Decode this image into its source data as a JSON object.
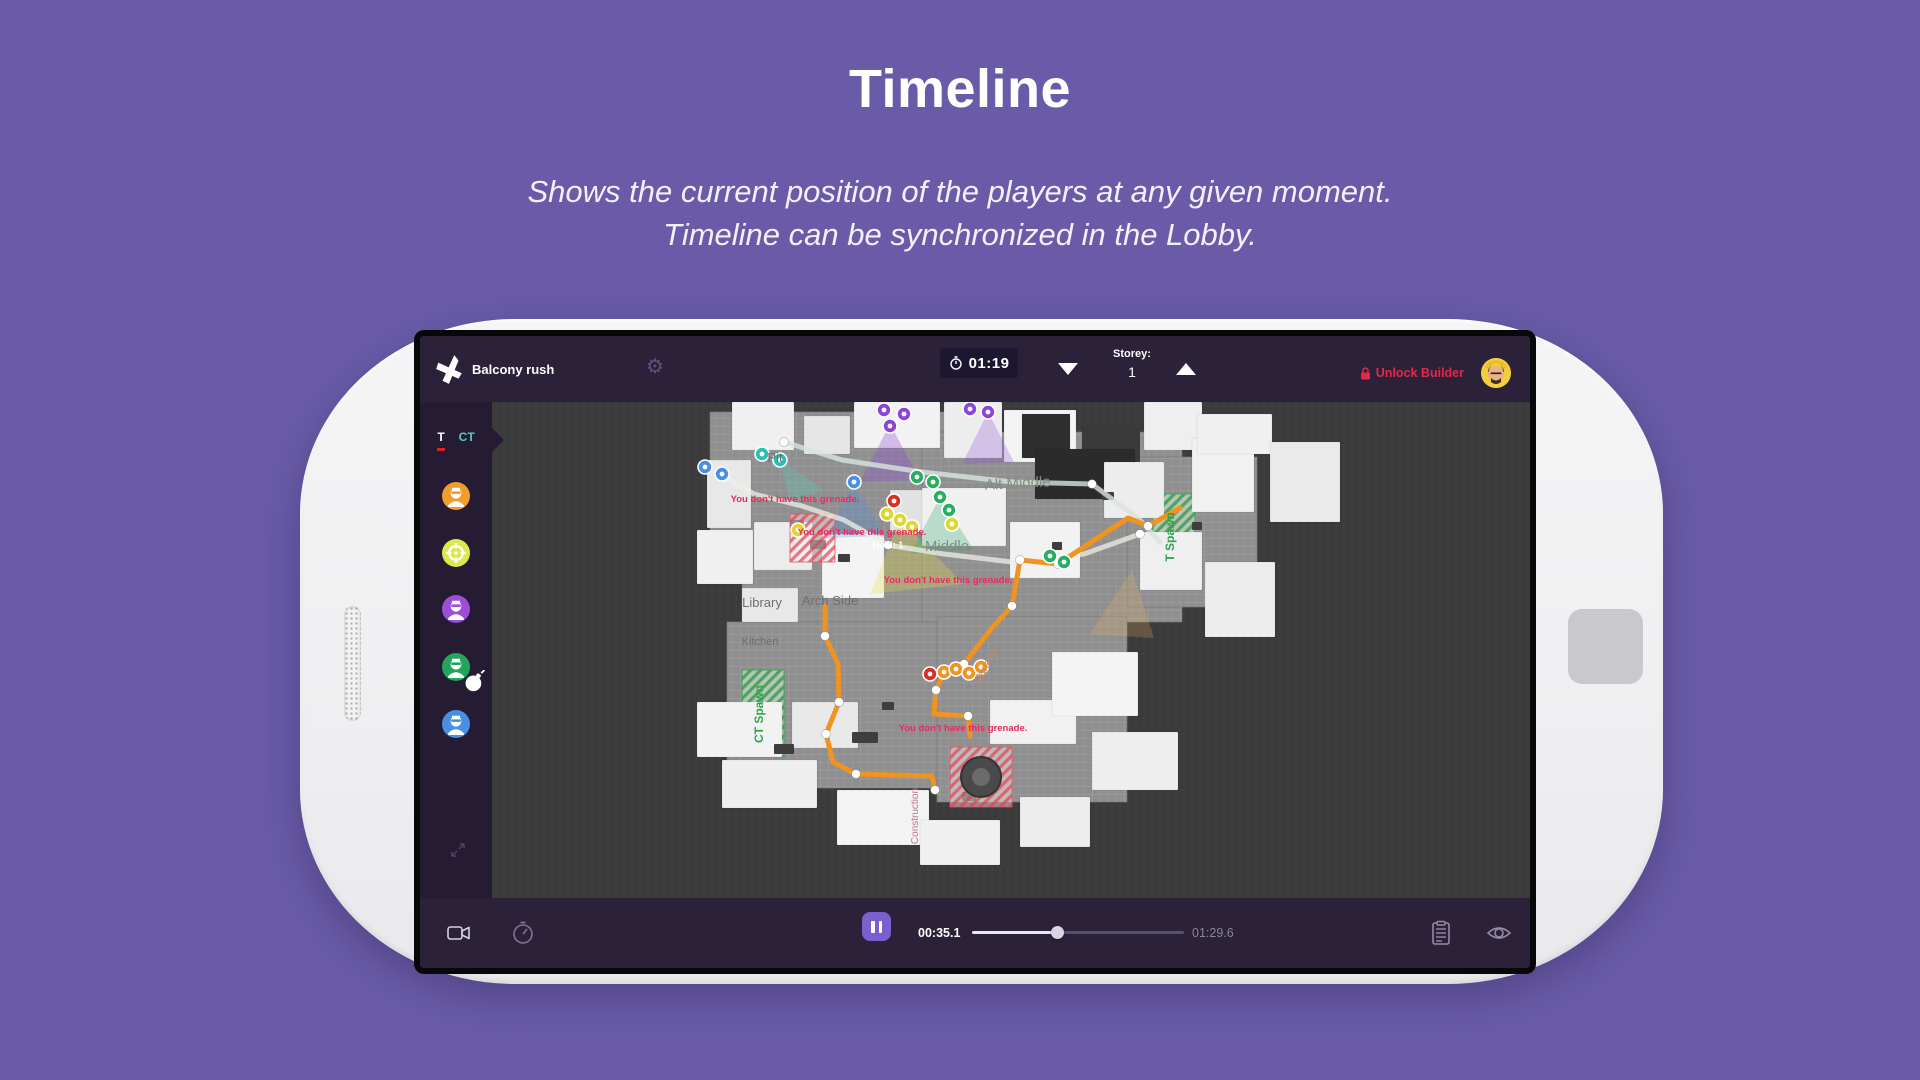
{
  "page": {
    "title": "Timeline",
    "subtitle_line1": "Shows the current position of the players at any given moment.",
    "subtitle_line2": "Timeline can be synchronized in the Lobby."
  },
  "app": {
    "topbar": {
      "strategy_name": "Balcony rush",
      "round_timer": "01:19",
      "storey_label": "Storey:",
      "storey_value": "1",
      "unlock_builder_label": "Unlock Builder"
    },
    "sidebar": {
      "tab_t": "T",
      "tab_ct": "CT",
      "players": [
        {
          "color": "#f09d2e",
          "icon": "terrorist"
        },
        {
          "color": "#dbe84e",
          "icon": "crosshair"
        },
        {
          "color": "#9b4fd6",
          "icon": "terrorist"
        },
        {
          "color": "#22a55c",
          "icon": "terrorist-bomb"
        },
        {
          "color": "#4a90e2",
          "icon": "terrorist"
        }
      ]
    },
    "timeline": {
      "current_time": "00:35.1",
      "total_time": "01:29.6",
      "progress_pct": 40
    },
    "map": {
      "warning_text": "You don't have this grenade.",
      "warnings": [
        [
          303,
          100
        ],
        [
          370,
          133
        ],
        [
          456,
          181
        ],
        [
          471,
          329
        ]
      ],
      "floors": [
        [
          218,
          10,
          240,
          120
        ],
        [
          250,
          120,
          210,
          100
        ],
        [
          235,
          220,
          215,
          166
        ],
        [
          430,
          30,
          260,
          190
        ],
        [
          445,
          215,
          190,
          185
        ],
        [
          635,
          55,
          130,
          150
        ]
      ],
      "buildings": [
        [
          240,
          0,
          62,
          48,
          "#f0f0f0"
        ],
        [
          312,
          14,
          46,
          38,
          "#e6e6e6"
        ],
        [
          362,
          0,
          86,
          46,
          "#f2f2f2"
        ],
        [
          452,
          0,
          58,
          56,
          "#ededed"
        ],
        [
          512,
          8,
          72,
          52,
          "#f4f4f4"
        ],
        [
          530,
          12,
          48,
          44,
          "#2e2e2e"
        ],
        [
          590,
          26,
          58,
          40,
          "#3a3a3a"
        ],
        [
          652,
          0,
          58,
          48,
          "#efefef"
        ],
        [
          700,
          36,
          62,
          74,
          "#f1f1f1"
        ],
        [
          705,
          12,
          75,
          40,
          "#f0f0f0"
        ],
        [
          778,
          40,
          70,
          80,
          "#eaeaea"
        ],
        [
          713,
          160,
          70,
          75,
          "#ededed"
        ],
        [
          215,
          58,
          44,
          68,
          "#e8e8e8"
        ],
        [
          205,
          128,
          56,
          54,
          "#f0f0f0"
        ],
        [
          262,
          120,
          58,
          48,
          "#ececec"
        ],
        [
          330,
          132,
          62,
          64,
          "#f4f4f4"
        ],
        [
          398,
          88,
          52,
          42,
          "#e2e2e2"
        ],
        [
          430,
          86,
          84,
          58,
          "#f0f0f0"
        ],
        [
          543,
          47,
          100,
          50,
          "#2b2b2b"
        ],
        [
          518,
          120,
          70,
          56,
          "#f2f2f2"
        ],
        [
          612,
          60,
          60,
          56,
          "#ededed"
        ],
        [
          648,
          130,
          62,
          58,
          "#efefef"
        ],
        [
          250,
          186,
          56,
          34,
          "#e8e8e8"
        ],
        [
          205,
          300,
          85,
          55,
          "#f2f2f2"
        ],
        [
          230,
          358,
          95,
          48,
          "#eeeeee"
        ],
        [
          300,
          300,
          66,
          46,
          "#e9e9e9"
        ],
        [
          345,
          388,
          92,
          55,
          "#f3f3f3"
        ],
        [
          498,
          298,
          86,
          44,
          "#f1f1f1"
        ],
        [
          560,
          250,
          86,
          64,
          "#f4f4f4"
        ],
        [
          600,
          330,
          86,
          58,
          "#eeeeee"
        ],
        [
          528,
          395,
          70,
          50,
          "#ededed"
        ],
        [
          428,
          418,
          80,
          45,
          "#f0f0f0"
        ]
      ],
      "props": [
        [
          298,
          118,
          14,
          9
        ],
        [
          318,
          138,
          16,
          9
        ],
        [
          346,
          152,
          12,
          8
        ],
        [
          282,
          342,
          20,
          10
        ],
        [
          390,
          300,
          12,
          8
        ],
        [
          560,
          140,
          10,
          8
        ],
        [
          610,
          90,
          12,
          8
        ],
        [
          700,
          120,
          10,
          8
        ],
        [
          470,
          390,
          14,
          9
        ],
        [
          360,
          330,
          26,
          11
        ]
      ],
      "zones_green": [
        [
          250,
          268,
          42,
          87
        ],
        [
          661,
          92,
          42,
          85
        ]
      ],
      "zones_red": [
        [
          298,
          112,
          45,
          48
        ],
        [
          458,
          345,
          62,
          60
        ]
      ],
      "fountain": {
        "cx": 489,
        "cy": 375,
        "r": 20
      },
      "cones": [
        {
          "p": [
            [
              398,
              22
            ],
            [
              368,
              80
            ],
            [
              428,
              78
            ]
          ],
          "f": "rgba(140,70,215,0.32)"
        },
        {
          "p": [
            [
              496,
              10
            ],
            [
              470,
              62
            ],
            [
              522,
              60
            ]
          ],
          "f": "rgba(140,70,215,0.26)"
        },
        {
          "p": [
            [
              408,
              118
            ],
            [
              378,
              192
            ],
            [
              472,
              182
            ]
          ],
          "f": "rgba(232,222,70,0.30)"
        },
        {
          "p": [
            [
              448,
              95
            ],
            [
              418,
              152
            ],
            [
              482,
              148
            ]
          ],
          "f": "rgba(40,170,100,0.28)"
        },
        {
          "p": [
            [
              362,
              80
            ],
            [
              334,
              136
            ],
            [
              394,
              134
            ]
          ],
          "f": "rgba(75,140,235,0.26)"
        },
        {
          "p": [
            [
              288,
              58
            ],
            [
              298,
              102
            ],
            [
              332,
              88
            ]
          ],
          "f": "rgba(80,210,190,0.26)"
        },
        {
          "p": [
            [
              640,
              168
            ],
            [
              598,
              232
            ],
            [
              662,
              236
            ]
          ],
          "f": "rgba(240,180,90,0.22)"
        }
      ],
      "paths": [
        {
          "c": "#d9e4dc",
          "o": 0.8,
          "w": 5,
          "pts": [
            [
              292,
              40
            ],
            [
              350,
              58
            ],
            [
              430,
              70
            ],
            [
              520,
              80
            ],
            [
              600,
              82
            ],
            [
              648,
              118
            ],
            [
              668,
              140
            ]
          ],
          "wps": [
            [
              292,
              40
            ],
            [
              600,
              82
            ]
          ]
        },
        {
          "c": "#efefe8",
          "o": 0.75,
          "w": 5,
          "pts": [
            [
              228,
              72
            ],
            [
              262,
              92
            ],
            [
              310,
              104
            ],
            [
              352,
              118
            ],
            [
              396,
              143
            ],
            [
              452,
              152
            ],
            [
              520,
              160
            ],
            [
              592,
              152
            ],
            [
              648,
              132
            ]
          ],
          "wps": [
            [
              228,
              72
            ],
            [
              396,
              143
            ],
            [
              648,
              132
            ]
          ]
        },
        {
          "c": "#f09320",
          "o": 1,
          "w": 5,
          "pts": [
            [
              688,
              106
            ],
            [
              656,
              124
            ],
            [
              636,
              116
            ],
            [
              566,
              162
            ],
            [
              528,
              158
            ],
            [
              520,
              204
            ],
            [
              500,
              226
            ],
            [
              472,
              262
            ],
            [
              452,
              270
            ],
            [
              444,
              288
            ],
            [
              442,
              312
            ],
            [
              476,
              314
            ],
            [
              478,
              334
            ]
          ],
          "wps": [
            [
              656,
              124
            ],
            [
              566,
              162
            ],
            [
              528,
              158
            ],
            [
              520,
              204
            ],
            [
              472,
              262
            ],
            [
              444,
              288
            ],
            [
              476,
              314
            ]
          ]
        },
        {
          "c": "#f09320",
          "o": 1,
          "w": 5,
          "pts": [
            [
              333,
              204
            ],
            [
              333,
              234
            ],
            [
              346,
              262
            ],
            [
              347,
              300
            ],
            [
              334,
              332
            ],
            [
              341,
              360
            ],
            [
              364,
              372
            ],
            [
              440,
              374
            ],
            [
              443,
              388
            ]
          ],
          "wps": [
            [
              333,
              234
            ],
            [
              347,
              300
            ],
            [
              334,
              332
            ],
            [
              364,
              372
            ],
            [
              443,
              388
            ]
          ]
        }
      ],
      "markers": [
        {
          "x": 392,
          "y": 8,
          "c": "#8e44d8"
        },
        {
          "x": 412,
          "y": 12,
          "c": "#8e44d8"
        },
        {
          "x": 398,
          "y": 24,
          "c": "#8e44d8"
        },
        {
          "x": 478,
          "y": 7,
          "c": "#8e44d8"
        },
        {
          "x": 496,
          "y": 10,
          "c": "#8e44d8"
        },
        {
          "x": 270,
          "y": 52,
          "c": "#2abfae"
        },
        {
          "x": 288,
          "y": 58,
          "c": "#2abfae"
        },
        {
          "x": 213,
          "y": 65,
          "c": "#4a90e2"
        },
        {
          "x": 230,
          "y": 72,
          "c": "#4a90e2"
        },
        {
          "x": 362,
          "y": 80,
          "c": "#4a90e2"
        },
        {
          "x": 425,
          "y": 75,
          "c": "#27ae60"
        },
        {
          "x": 441,
          "y": 80,
          "c": "#27ae60"
        },
        {
          "x": 448,
          "y": 95,
          "c": "#27ae60"
        },
        {
          "x": 457,
          "y": 108,
          "c": "#27ae60"
        },
        {
          "x": 558,
          "y": 154,
          "c": "#27ae60"
        },
        {
          "x": 572,
          "y": 160,
          "c": "#27ae60"
        },
        {
          "x": 395,
          "y": 112,
          "c": "#ddd62e"
        },
        {
          "x": 408,
          "y": 118,
          "c": "#ddd62e"
        },
        {
          "x": 420,
          "y": 125,
          "c": "#ddd62e"
        },
        {
          "x": 460,
          "y": 122,
          "c": "#ddd62e"
        },
        {
          "x": 306,
          "y": 128,
          "c": "#ddd62e"
        },
        {
          "x": 452,
          "y": 270,
          "c": "#f09320"
        },
        {
          "x": 464,
          "y": 267,
          "c": "#f09320"
        },
        {
          "x": 477,
          "y": 271,
          "c": "#f09320"
        },
        {
          "x": 489,
          "y": 265,
          "c": "#f09320"
        },
        {
          "x": 438,
          "y": 272,
          "c": "#d93025"
        },
        {
          "x": 402,
          "y": 99,
          "c": "#d93025"
        }
      ],
      "labels": [
        {
          "t": "Pit",
          "x": 283,
          "y": 60,
          "s": 13,
          "c": "#6e6e6e",
          "r": 0,
          "w": 400
        },
        {
          "t": "Alt Middle",
          "x": 526,
          "y": 86,
          "s": 15,
          "c": "#7f8f84",
          "r": -3,
          "w": 400
        },
        {
          "t": "Middle",
          "x": 455,
          "y": 149,
          "s": 15,
          "c": "#8b8b8b",
          "r": 0,
          "w": 400
        },
        {
          "t": "Hold: 1",
          "x": 396,
          "y": 146,
          "s": 9,
          "c": "#ffffff",
          "r": 0,
          "w": 700
        },
        {
          "t": "Library",
          "x": 270,
          "y": 205,
          "s": 13,
          "c": "#6e6e6e",
          "r": 0,
          "w": 400
        },
        {
          "t": "Arch Side",
          "x": 338,
          "y": 203,
          "s": 13,
          "c": "#6e6e6e",
          "r": 0,
          "w": 400
        },
        {
          "t": "Kitchen",
          "x": 268,
          "y": 243,
          "s": 11,
          "c": "#6e6e6e",
          "r": 0,
          "w": 400
        },
        {
          "t": "Banana",
          "x": 497,
          "y": 265,
          "s": 11,
          "c": "#c0896c",
          "r": -62,
          "w": 400
        },
        {
          "t": "Construction",
          "x": 426,
          "y": 414,
          "s": 10,
          "c": "#c27488",
          "r": -90,
          "w": 400
        },
        {
          "t": "CT Spawn",
          "x": 271,
          "y": 312,
          "s": 12,
          "c": "#2da44e",
          "r": -90,
          "w": 700
        },
        {
          "t": "T Spawn",
          "x": 682,
          "y": 135,
          "s": 12,
          "c": "#2da44e",
          "r": -90,
          "w": 700
        }
      ]
    }
  },
  "colors": {
    "page_bg": "#695ba7",
    "bar_bg": "#2b2139",
    "sidebar_bg": "#251c33",
    "accent_purple": "#7b5fd0",
    "accent_red": "#e5274a",
    "tab_ct_teal": "#4fd1c5",
    "warning_pink": "#ea2a60",
    "path_orange": "#f09320"
  }
}
